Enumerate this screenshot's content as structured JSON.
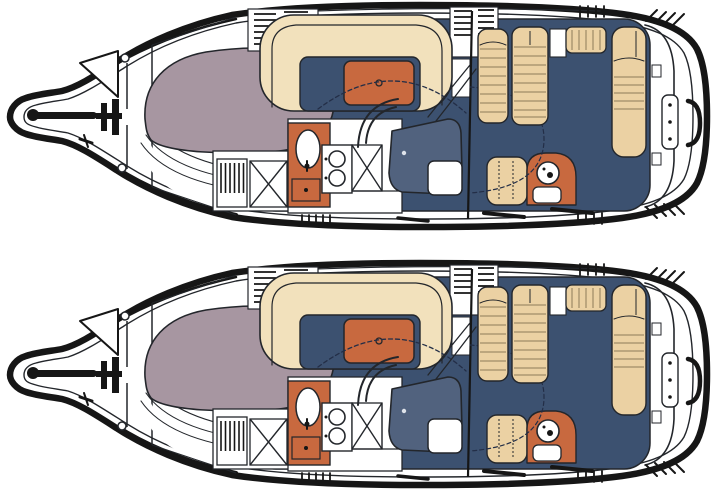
{
  "page": {
    "title": "Motor yacht floor plans",
    "description": "Two near-identical top-view boat interior floor plans stacked vertically on a white background",
    "background": "#ffffff"
  },
  "colors": {
    "hull": "#161616",
    "line": "#23262b",
    "deck": "#ffffff",
    "navy": "#3c5170",
    "mauve": "#a796a1",
    "orange": "#c8693f",
    "cream": "#f2e1bc",
    "tan": "#ebd1a3",
    "slate": "#51627e",
    "stripe": "#8d7b59",
    "dash": "#232e47"
  },
  "plans": [
    {
      "id": "floorplan-top",
      "position": "top"
    },
    {
      "id": "floorplan-bottom",
      "position": "bottom"
    }
  ],
  "regions": [
    "anchor-roller",
    "windlass",
    "anchor-locker-hatch",
    "bow-cleat",
    "deck-rings",
    "v-berth",
    "berth-steps",
    "dinette-settee",
    "dinette-table",
    "vent-panels",
    "hanging-locker",
    "crossed-door-cabinets",
    "galley-counter",
    "galley-sink",
    "galley-stove",
    "galley-drawer",
    "helm-console",
    "helm-seat",
    "steering-wheel",
    "arch-supports",
    "canvas-outline",
    "aft-seat",
    "wet-bar-sink",
    "windshield-bulkhead",
    "cockpit-benches",
    "sun-pad",
    "cockpit-sole",
    "transom",
    "swim-platform-panel",
    "grab-handle",
    "corner-vents",
    "grab-rails"
  ]
}
